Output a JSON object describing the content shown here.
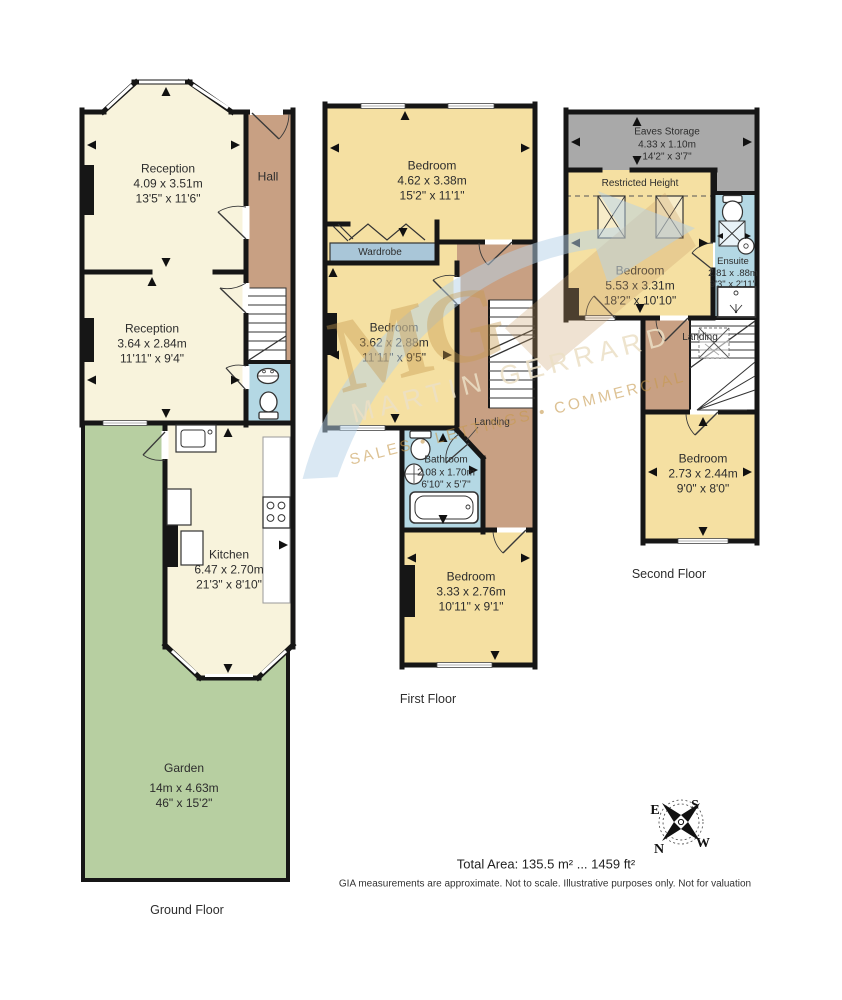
{
  "watermark": {
    "monogram": "MG",
    "line1": "MARTIN GERRARD",
    "line2": "SALES • LETTINGS • COMMERCIAL"
  },
  "colors": {
    "cream": "#f8f3dc",
    "yellow": "#f5e0a2",
    "hall_tan": "#c8a083",
    "garden_green": "#b7cfa1",
    "bath_blue": "#b4d8e4",
    "wardrobe_blue": "#a9c6d8",
    "eaves_gray": "#a9a9a9",
    "wall": "#161616",
    "watermark_blue": "#b5d2e8",
    "watermark_gold": "#c79a4e"
  },
  "floors": {
    "ground": {
      "label": "Ground Floor",
      "rooms": {
        "reception1": {
          "name": "Reception",
          "metric": "4.09 x 3.51m",
          "imperial": "13'5\" x 11'6\""
        },
        "hall": {
          "name": "Hall"
        },
        "reception2": {
          "name": "Reception",
          "metric": "3.64 x 2.84m",
          "imperial": "11'11\" x 9'4\""
        },
        "kitchen": {
          "name": "Kitchen",
          "metric": "6.47 x 2.70m",
          "imperial": "21'3\" x 8'10\""
        },
        "garden": {
          "name": "Garden",
          "metric": "14m x 4.63m",
          "imperial": "46\" x 15'2\""
        }
      }
    },
    "first": {
      "label": "First Floor",
      "rooms": {
        "bedroom1": {
          "name": "Bedroom",
          "metric": "4.62 x 3.38m",
          "imperial": "15'2\" x 11'1\""
        },
        "wardrobe": {
          "name": "Wardrobe"
        },
        "bedroom2": {
          "name": "Bedroom",
          "metric": "3.62 x 2.88m",
          "imperial": "11'11\" x 9'5\""
        },
        "bathroom": {
          "name": "Bathroom",
          "metric": "2.08 x 1.70m",
          "imperial": "6'10\" x 5'7\""
        },
        "landing": {
          "name": "Landing"
        },
        "bedroom3": {
          "name": "Bedroom",
          "metric": "3.33 x 2.76m",
          "imperial": "10'11\" x 9'1\""
        }
      }
    },
    "second": {
      "label": "Second Floor",
      "rooms": {
        "eaves": {
          "name": "Eaves Storage",
          "metric": "4.33 x 1.10m",
          "imperial": "14'2\" x 3'7\""
        },
        "restricted": {
          "name": "Restricted Height"
        },
        "bedroom1": {
          "name": "Bedroom",
          "metric": "5.53 x 3.31m",
          "imperial": "18'2\" x 10'10\""
        },
        "ensuite": {
          "name": "Ensuite",
          "metric": "2.81 x .88m",
          "imperial": "9'3\" x 2'11\""
        },
        "landing": {
          "name": "Landing"
        },
        "bedroom2": {
          "name": "Bedroom",
          "metric": "2.73 x 2.44m",
          "imperial": "9'0\" x 8'0\""
        }
      }
    }
  },
  "compass": {
    "n": "N",
    "e": "E",
    "s": "S",
    "w": "W"
  },
  "footer": {
    "total_area": "Total Area: 135.5 m² ... 1459 ft²",
    "disclaimer": "GIA measurements are approximate. Not to scale. Illustrative purposes only. Not for valuation"
  }
}
